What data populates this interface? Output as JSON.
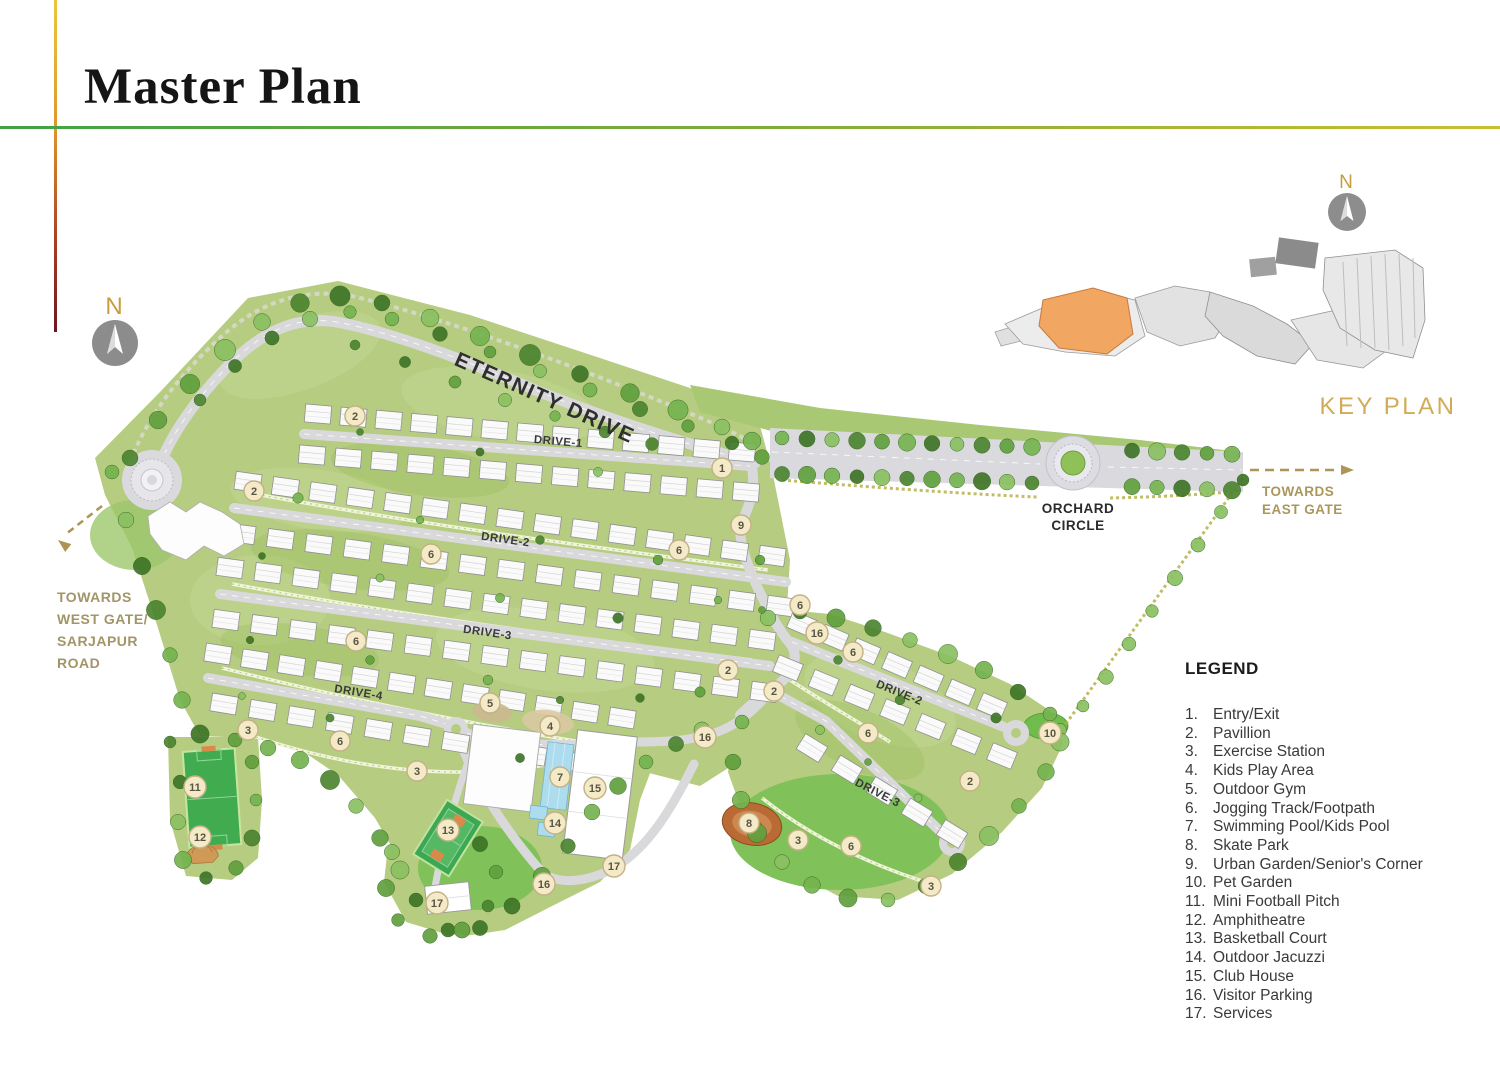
{
  "page": {
    "title": "Master Plan"
  },
  "compass": {
    "west_label": "N",
    "key_label": "N"
  },
  "map": {
    "road_labels": {
      "eternity": "ETERNITY DRIVE",
      "drive1": "DRIVE-1",
      "drive2": "DRIVE-2",
      "drive3": "DRIVE-3",
      "drive4": "DRIVE-4",
      "east_drive2": "DRIVE-2",
      "east_drive3": "DRIVE-3"
    },
    "labels": {
      "orchard_line1": "ORCHARD",
      "orchard_line2": "CIRCLE",
      "towards_east_line1": "TOWARDS",
      "towards_east_line2": "EAST GATE",
      "towards_west_line1": "TOWARDS",
      "towards_west_line2": "WEST GATE/",
      "towards_west_line3": "SARJAPUR",
      "towards_west_line4": "ROAD",
      "key_plan": "KEY PLAN"
    },
    "colors": {
      "land_green": "#b6cc80",
      "road_gray": "#d9d9dc",
      "marker_fill": "#f4eac7",
      "gold_accent": "#ab975c",
      "key_plan_highlight": "#f1a661"
    },
    "markers": [
      {
        "n": "1",
        "x": 722,
        "y": 468
      },
      {
        "n": "2",
        "x": 355,
        "y": 416
      },
      {
        "n": "2",
        "x": 254,
        "y": 491
      },
      {
        "n": "2",
        "x": 728,
        "y": 670
      },
      {
        "n": "2",
        "x": 774,
        "y": 691
      },
      {
        "n": "2",
        "x": 970,
        "y": 781
      },
      {
        "n": "3",
        "x": 248,
        "y": 730
      },
      {
        "n": "3",
        "x": 417,
        "y": 771
      },
      {
        "n": "3",
        "x": 798,
        "y": 840
      },
      {
        "n": "3",
        "x": 931,
        "y": 886
      },
      {
        "n": "4",
        "x": 550,
        "y": 726
      },
      {
        "n": "5",
        "x": 490,
        "y": 703
      },
      {
        "n": "6",
        "x": 431,
        "y": 554
      },
      {
        "n": "6",
        "x": 679,
        "y": 550
      },
      {
        "n": "6",
        "x": 356,
        "y": 641
      },
      {
        "n": "6",
        "x": 340,
        "y": 741
      },
      {
        "n": "6",
        "x": 800,
        "y": 605
      },
      {
        "n": "6",
        "x": 853,
        "y": 652
      },
      {
        "n": "6",
        "x": 868,
        "y": 733
      },
      {
        "n": "6",
        "x": 851,
        "y": 846
      },
      {
        "n": "7",
        "x": 560,
        "y": 777
      },
      {
        "n": "8",
        "x": 749,
        "y": 823
      },
      {
        "n": "9",
        "x": 741,
        "y": 525
      },
      {
        "n": "10",
        "x": 1050,
        "y": 733
      },
      {
        "n": "11",
        "x": 195,
        "y": 787
      },
      {
        "n": "12",
        "x": 200,
        "y": 837
      },
      {
        "n": "13",
        "x": 448,
        "y": 830
      },
      {
        "n": "14",
        "x": 555,
        "y": 823
      },
      {
        "n": "15",
        "x": 595,
        "y": 788
      },
      {
        "n": "16",
        "x": 817,
        "y": 633
      },
      {
        "n": "16",
        "x": 705,
        "y": 737
      },
      {
        "n": "16",
        "x": 544,
        "y": 884
      },
      {
        "n": "17",
        "x": 614,
        "y": 866
      },
      {
        "n": "17",
        "x": 437,
        "y": 903
      }
    ]
  },
  "legend": {
    "title": "LEGEND",
    "items": [
      {
        "num": "1.",
        "label": "Entry/Exit"
      },
      {
        "num": "2.",
        "label": "Pavillion"
      },
      {
        "num": "3.",
        "label": "Exercise Station"
      },
      {
        "num": "4.",
        "label": "Kids Play Area"
      },
      {
        "num": "5.",
        "label": "Outdoor Gym"
      },
      {
        "num": "6.",
        "label": "Jogging Track/Footpath"
      },
      {
        "num": "7.",
        "label": "Swimming Pool/Kids Pool"
      },
      {
        "num": "8.",
        "label": "Skate Park"
      },
      {
        "num": "9.",
        "label": "Urban Garden/Senior's Corner"
      },
      {
        "num": "10.",
        "label": "Pet Garden"
      },
      {
        "num": "11.",
        "label": "Mini Football Pitch"
      },
      {
        "num": "12.",
        "label": "Amphitheatre"
      },
      {
        "num": "13.",
        "label": "Basketball Court"
      },
      {
        "num": "14.",
        "label": "Outdoor Jacuzzi"
      },
      {
        "num": "15.",
        "label": "Club House"
      },
      {
        "num": "16.",
        "label": "Visitor Parking"
      },
      {
        "num": "17.",
        "label": "Services"
      }
    ]
  }
}
